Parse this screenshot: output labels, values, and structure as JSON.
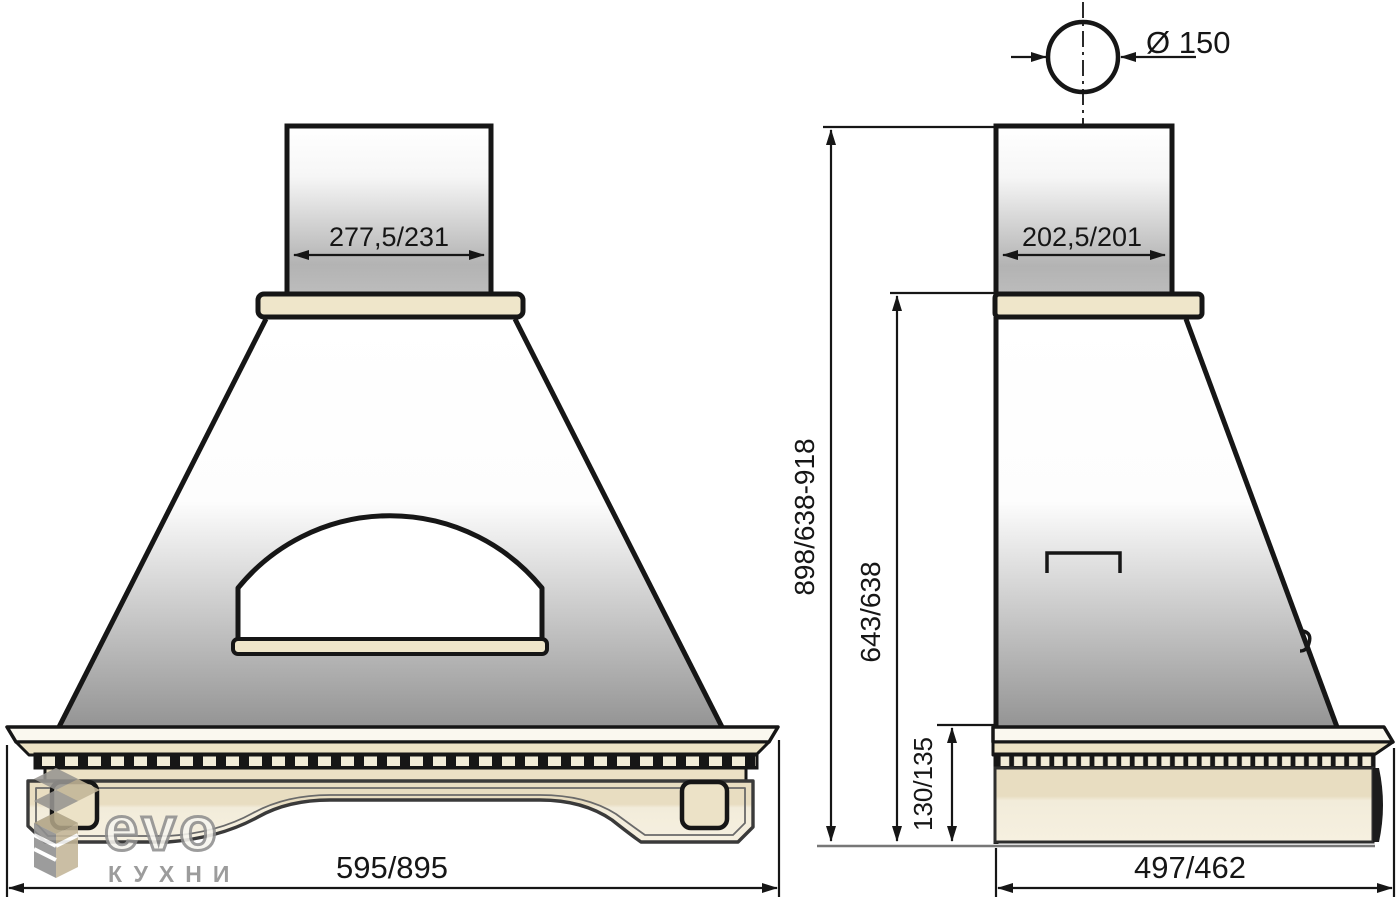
{
  "title": "Kitchen hood dimensional drawing",
  "front_view": {
    "chimney_width_label": "277,5/231",
    "overall_width_label": "595/895"
  },
  "side_view": {
    "flue_diameter_label": "Ø 150",
    "chimney_depth_label": "202,5/201",
    "overall_depth_label": "497/462",
    "total_height_label": "898/638-918",
    "body_height_label": "643/638",
    "cornice_height_label": "130/135"
  },
  "logo": {
    "brand": "evo",
    "subtitle": "КУХНИ"
  },
  "colors": {
    "cream": "#efe6ca",
    "cream_dark": "#e8ddc1",
    "band_white": "#faf8ef",
    "line": "#161616",
    "gray_outline": "#3a3a3a",
    "logo_gray": "#8f8f8f"
  }
}
